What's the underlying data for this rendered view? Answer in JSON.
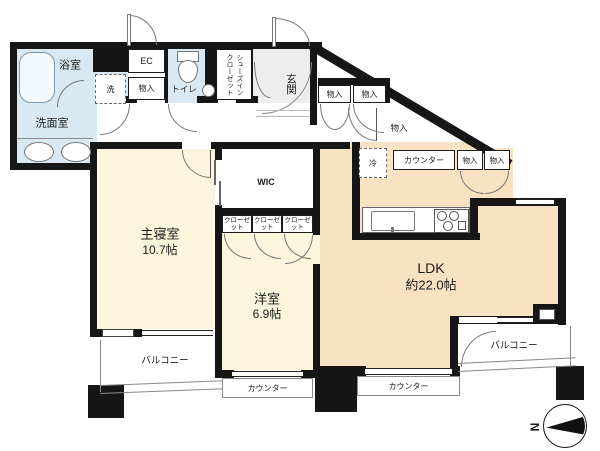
{
  "colors": {
    "wall": "#161616",
    "wet_area_blue": "#d9e9f3",
    "room_cream": "#faf5dc",
    "ldk_peach": "#f9e2c2",
    "entrance_gray": "#ededed",
    "line_gray": "#8a8a8a"
  },
  "labels": {
    "bathroom": "浴室",
    "washroom": "洗面室",
    "ec": "EC",
    "hall_storage": "物入",
    "washer": "洗",
    "toilet": "トイレ",
    "shoes_closet": "シューズインクローゼット",
    "entrance": "玄関",
    "entrance_storage_a": "物入",
    "entrance_storage_b": "物入",
    "corridor_storage": "物入",
    "fridge": "冷",
    "kitchen_counter": "カウンター",
    "kitchen_storage_a": "物入",
    "kitchen_storage_b": "物入",
    "wic": "WIC",
    "closet_a": "クローゼット",
    "closet_b": "クローゼット",
    "closet_c": "クローゼット",
    "master_bedroom": "主寝室",
    "master_bedroom_size": "10.7帖",
    "western_room": "洋室",
    "western_room_size": "6.9帖",
    "ldk": "LDK",
    "ldk_size": "約22.0帖",
    "balcony_left": "バルコニー",
    "balcony_right": "バルコニー",
    "counter_left": "カウンター",
    "counter_right": "カウンター",
    "compass_north": "N"
  }
}
